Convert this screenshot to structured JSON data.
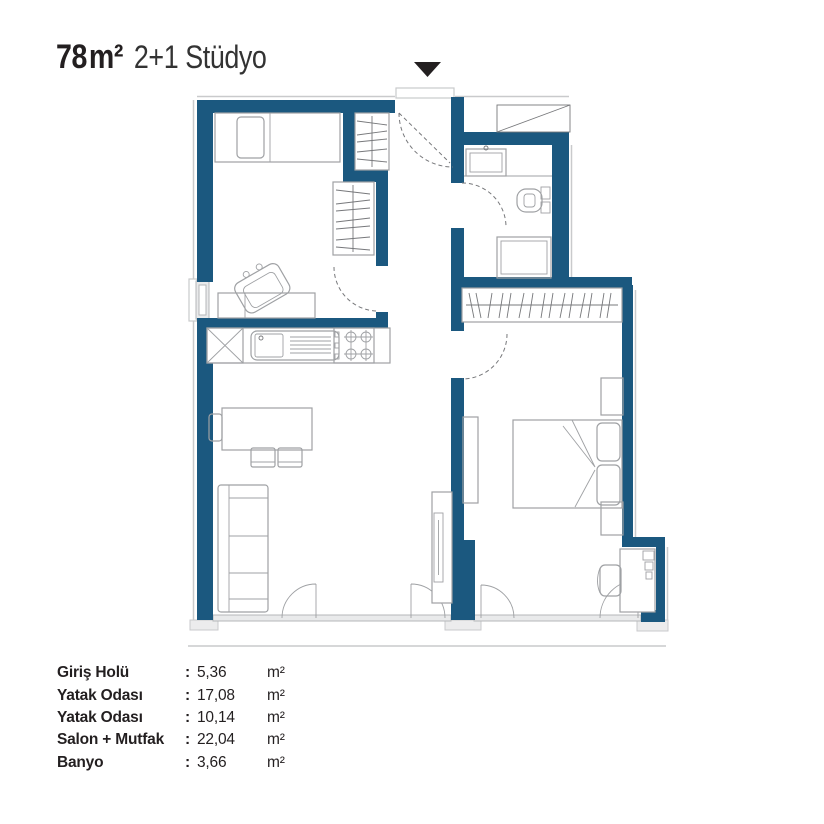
{
  "header": {
    "area": "78",
    "area_unit": "m²",
    "subtitle": "2+1 Stüdyo"
  },
  "marker": {
    "name": "entrance-direction-marker"
  },
  "legend": {
    "rows": [
      {
        "label": "Giriş Holü",
        "sep": ":",
        "value": "5,36",
        "unit": "m²"
      },
      {
        "label": "Yatak Odası",
        "sep": ":",
        "value": "17,08",
        "unit": "m²"
      },
      {
        "label": "Yatak Odası",
        "sep": ":",
        "value": "10,14",
        "unit": "m²"
      },
      {
        "label": "Salon + Mutfak",
        "sep": ":",
        "value": "22,04",
        "unit": "m²"
      },
      {
        "label": "Banyo",
        "sep": ":",
        "value": "3,66",
        "unit": "m²"
      }
    ]
  },
  "colors": {
    "wall": "#1b587f",
    "ink": "#231f20",
    "sub": "#333333",
    "line": "#9fa1a4",
    "line_dark": "#77787b",
    "face": "#c9cacc",
    "window_fill": "#e9eaeb",
    "window_line": "#b5b7b9",
    "cap_fill": "#ececed",
    "bg": "#ffffff"
  }
}
